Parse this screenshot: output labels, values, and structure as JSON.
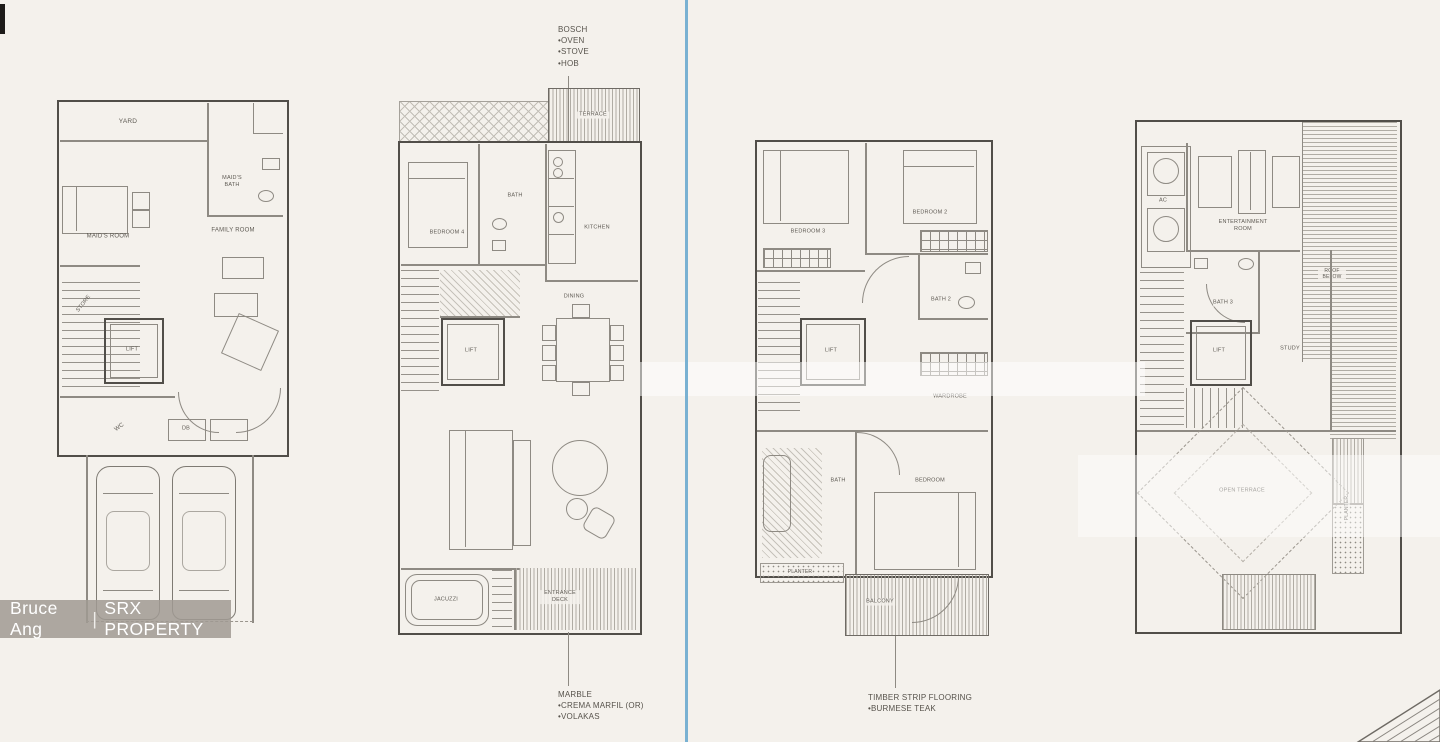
{
  "watermark": {
    "agent": "Bruce Ang",
    "separator": "|",
    "brand": "SRX PROPERTY"
  },
  "annotations": {
    "appliance": [
      "BOSCH",
      "•OVEN",
      "•STOVE",
      "•HOB"
    ],
    "marble": [
      "MARBLE",
      "•CREMA MARFIL (OR)",
      "•VOLAKAS"
    ],
    "timber": [
      "TIMBER STRIP FLOORING",
      "•BURMESE TEAK"
    ]
  },
  "plan1": {
    "yard": "YARD",
    "maids_bath": "MAID'S BATH",
    "maids_room": "MAID'S ROOM",
    "family_room": "FAMILY ROOM",
    "store": "STORE",
    "lift": "LIFT",
    "wc": "WC",
    "db": "DB"
  },
  "plan2": {
    "terrace": "TERRACE",
    "bedroom": "BEDROOM 4",
    "bath": "BATH",
    "kitchen": "KITCHEN",
    "dining": "DINING",
    "lift": "LIFT",
    "jacuzzi": "JACUZZI",
    "entrance_deck": "ENTRANCE DECK"
  },
  "plan3": {
    "bedroom3": "BEDROOM 3",
    "bedroom2": "BEDROOM 2",
    "bath2": "BATH 2",
    "lift": "LIFT",
    "wardrobe": "WARDROBE",
    "bath": "BATH",
    "bedroom": "BEDROOM",
    "planter": "PLANTER",
    "balcony": "BALCONY"
  },
  "plan4": {
    "ac": "AC",
    "entertainment_room": "ENTERTAINMENT ROOM",
    "bath3": "BATH 3",
    "lift": "LIFT",
    "study": "STUDY",
    "roof": "ROOF BELOW",
    "open_terrace": "OPEN TERRACE",
    "planter": "PLANTER"
  }
}
